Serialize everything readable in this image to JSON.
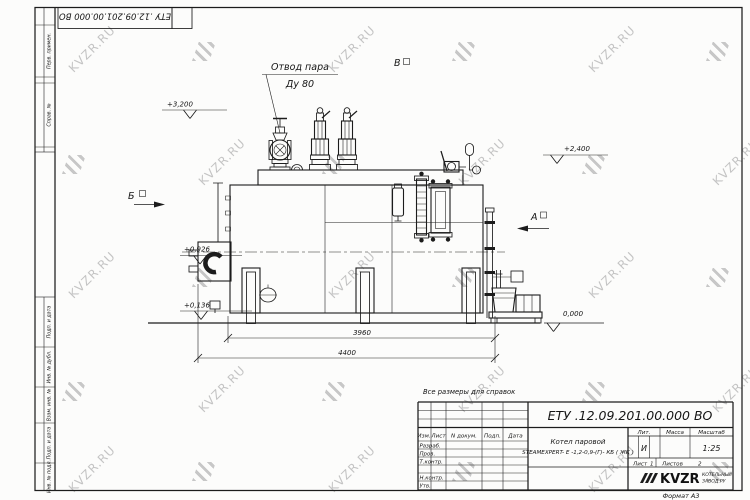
{
  "watermark": {
    "text": "KVZR.RU",
    "color": "#c4c4c4"
  },
  "margin_column": {
    "boxes": [
      "Перв. примен.",
      "Справ. №",
      "Подп. и дата",
      "Инв. № дубл.",
      "Взам. инв. №",
      "Подп. и дата",
      "Инв. № подл."
    ]
  },
  "drawing": {
    "callout": {
      "line1": "Отвод пара",
      "line2": "Ду 80"
    },
    "views": {
      "b": "Б",
      "v": "В",
      "a": "А"
    },
    "elevations": {
      "e3200": "+3,200",
      "e2400": "+2,400",
      "e0926": "+0,926",
      "e0136": "+0,136",
      "zero": "0,000"
    },
    "dimensions": {
      "d3960": "3960",
      "d4400": "4400"
    }
  },
  "title_block": {
    "note": "Все размеры для справок",
    "doc_number": "ЕТУ .12.09.201.00.000  ВО",
    "columns": {
      "izm": "Изм.",
      "list": "Лист",
      "ndoc": "N докум.",
      "podp": "Подп.",
      "data": "Дата"
    },
    "rows": {
      "r1": "Разраб.",
      "r2": "Пров.",
      "r3": "Т.контр.",
      "r4": "Н.контр.",
      "r5": "Утв."
    },
    "product": {
      "line1": "Котел паровой",
      "line2": "STEAMEXPERT- Е -1,2-0,9-(Г)- КБ ( ЖК )"
    },
    "lit_label": "Лит.",
    "lit_value": "И",
    "mass_label": "Масса",
    "scale_label": "Масштаб",
    "scale_value": "1:25",
    "sheet_label": "Лист",
    "sheet_value": "1",
    "sheets_label": "Листов",
    "sheets_value": "2",
    "company": {
      "logo": "KVZR",
      "line1": "КОТЕЛЬНЫЙ",
      "line2": "ЗАВОД.РУ"
    },
    "format_note": "Формат А3"
  }
}
